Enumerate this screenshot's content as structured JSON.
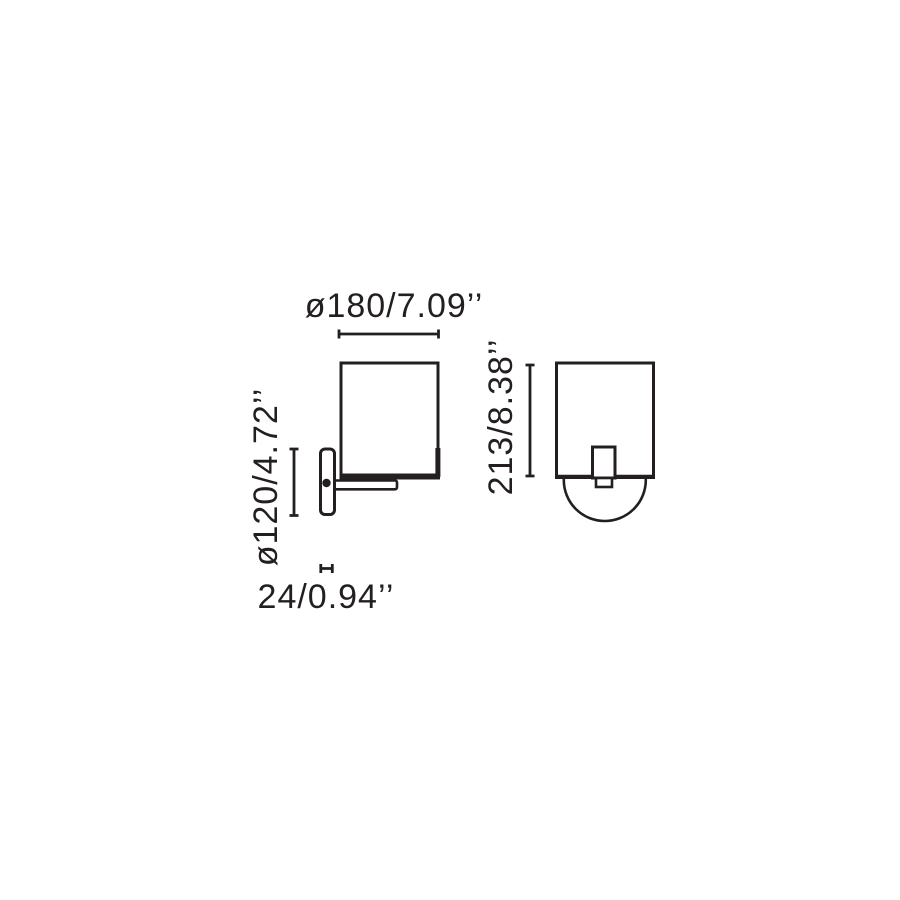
{
  "page": {
    "background_color": "#ffffff",
    "line_color": "#231f20"
  },
  "diagram": {
    "kind": "technical-dimension-drawing",
    "subject": "wall lamp",
    "dimensions": {
      "shade_diameter": {
        "label": "ø180/7.09’’",
        "mm": "180",
        "inches": "7.09",
        "orientation": "horizontal"
      },
      "plate_diameter": {
        "label": "ø120/4.72’’",
        "mm": "120",
        "inches": "4.72",
        "orientation": "vertical"
      },
      "plate_depth": {
        "label": "24/0.94’’",
        "mm": "24",
        "inches": "0.94",
        "orientation": "horizontal"
      },
      "total_height": {
        "label": "213/8.38’’",
        "mm": "213",
        "inches": "8.38",
        "orientation": "vertical"
      }
    }
  }
}
